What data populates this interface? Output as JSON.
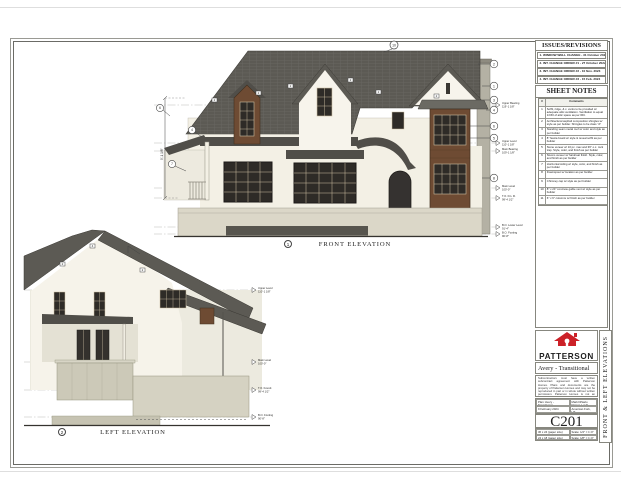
{
  "sheet": {
    "front_label": "FRONT ELEVATION",
    "left_label": "LEFT ELEVATION",
    "front_bubble": "1",
    "left_bubble": "2",
    "ridge_bubble": "10",
    "dim_left": "9'-1 1/8\""
  },
  "callouts": {
    "front_right": [
      "2",
      "1",
      "3",
      "4",
      "6",
      "5",
      "8"
    ],
    "front_left": [
      "6",
      "4",
      "7"
    ],
    "roof_tags": [
      "2",
      "2",
      "2",
      "2",
      "2",
      "2"
    ],
    "left_tags": [
      "2",
      "4",
      "2"
    ]
  },
  "levels": {
    "front": [
      {
        "name": "Upper Bearing",
        "elev": "119'-1 1/8\""
      },
      {
        "name": "Upper Level",
        "elev": "110'-1 1/8\""
      },
      {
        "name": "Main Bearing",
        "elev": "109'-1 1/8\""
      },
      {
        "name": "Main Level",
        "elev": "100'-0\""
      },
      {
        "name": "T.O. Fin. Fl.",
        "elev": "99'-4 1/2\""
      },
      {
        "name": "B.O. Lower Level",
        "elev": "91'-4\""
      },
      {
        "name": "B.O. Footing",
        "elev": "90'-8\""
      }
    ],
    "left": [
      {
        "name": "Upper Level",
        "elev": "110'-1 1/8\""
      },
      {
        "name": "Main Level",
        "elev": "100'-0\""
      },
      {
        "name": "T.O. Found.",
        "elev": "99'-4 1/2\""
      },
      {
        "name": "B.O. Footing",
        "elev": "90'-8\""
      }
    ]
  },
  "titleblock": {
    "issues_title": "ISSUES/REVISIONS",
    "issues": [
      {
        "num": "1.",
        "text": "WINDOW WELL CHANGE - 31 October 2022"
      },
      {
        "num": "2.",
        "text": "INT. CHANGE ORDER #1 - 27 October 2022"
      },
      {
        "num": "3.",
        "text": "INT. CHANGE ORDER #2 - 10 Nov. 2023"
      },
      {
        "num": "4.",
        "text": "INT. CHANGE ORDER #3 - 15 Feb. 2024"
      }
    ],
    "notes_title": "SHEET NOTES",
    "notes_header": {
      "num": "#",
      "comment": "Comments"
    },
    "notes": [
      {
        "num": "1",
        "text": "Soffit, ridge, & c. vents to be provided w/ adequate attic ventilation. Ventilation to equal 1/150 of attic space as per IRC."
      },
      {
        "num": "2",
        "text": "Architectural asphalt composition shingles w/ style as per builder. Shingles to be class \"A\""
      },
      {
        "num": "3",
        "text": "Standing seam metal roof w/ color and style as per builder"
      },
      {
        "num": "4",
        "text": "8\" fascia board w/ style & reveal soffit as per builder"
      },
      {
        "num": "5",
        "text": "Stone veneer w/ 10 pc. max and 36\" o.c. rock trap. Style, color, and finish as per builder"
      },
      {
        "num": "6",
        "text": "Stucco veneer w/ hardcoat finish. Style, color, and finish as per builder"
      },
      {
        "num": "7",
        "text": "Horizontal siding w/ style, color, and finish as per builder"
      },
      {
        "num": "8",
        "text": "Downspout w/ location as per builder"
      },
      {
        "num": "9",
        "text": "Chimney cap w/ style as per builder"
      },
      {
        "num": "10",
        "text": "8\" x 24\" concrete gable vent w/ style as per builder"
      },
      {
        "num": "11",
        "text": "6\" x 6\" columns w/ finish as per builder"
      }
    ],
    "brand": {
      "name": "PATTERSON",
      "sub": "H O M E S"
    },
    "plan_title": "Avery - Transitional",
    "disclaimer": "Subcontractors must have a written subcontract agreement with Patterson Homes. Plans and documents are the property of Patterson Homes and may not be reproduced in part or in whole without written permission. Patterson Homes is not an architect or engineer.",
    "info": {
      "plan": "Plan: Avery - Transitional",
      "date": "9 February 2024",
      "client": "Mark DiSario",
      "lot": "Draper, Lot 8",
      "city": "American Fork, UT"
    },
    "sheet_number": "C201",
    "scales": [
      {
        "paper": "36 x 24 (paper size)",
        "scale": "Scale: 1/4\" = 1'-0\""
      },
      {
        "paper": "24 x 18 (paper size)",
        "scale": "Scale: 1/8\" = 1'-0\""
      }
    ],
    "side_label": "FRONT & LEFT ELEVATIONS"
  },
  "colors": {
    "roof": "#5c5a54",
    "roof_dark": "#504e49",
    "wall": "#f3f0e5",
    "wood": "#6e4b33",
    "window": "#2e2b27",
    "concrete": "#dbd7c8",
    "brand_red": "#cc2128"
  }
}
